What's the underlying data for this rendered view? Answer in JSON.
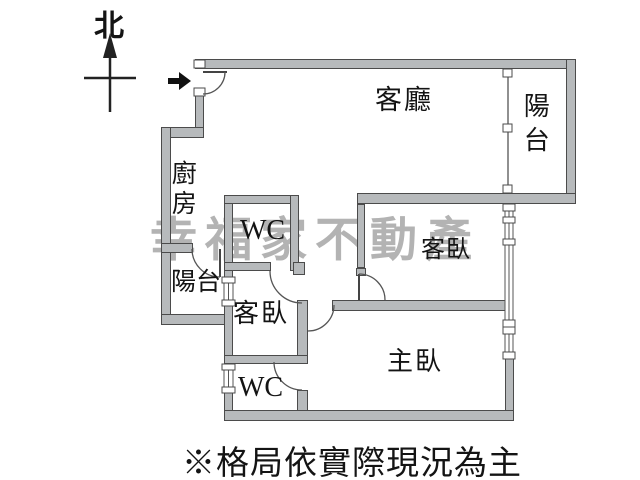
{
  "compass": {
    "north_label": "北"
  },
  "watermark": {
    "text": "幸福家不動產",
    "color": "#b3b3b3"
  },
  "rooms": {
    "living_room": {
      "label": "客廳"
    },
    "balcony_right": {
      "label": "陽台"
    },
    "kitchen": {
      "label": "廚房"
    },
    "wc_upper": {
      "label": "WC"
    },
    "bedroom_right": {
      "label": "客臥"
    },
    "balcony_left": {
      "label": "陽台"
    },
    "bedroom_left": {
      "label": "客臥"
    },
    "wc_lower": {
      "label": "WC"
    },
    "master_bedroom": {
      "label": "主臥"
    }
  },
  "footnote": "※格局依實際現況為主",
  "colors": {
    "wall_fill": "#b7babc",
    "wall_edge": "#4b4b4b",
    "line": "#555555",
    "text": "#141414",
    "watermark": "#b3b3b3",
    "background": "#ffffff"
  }
}
